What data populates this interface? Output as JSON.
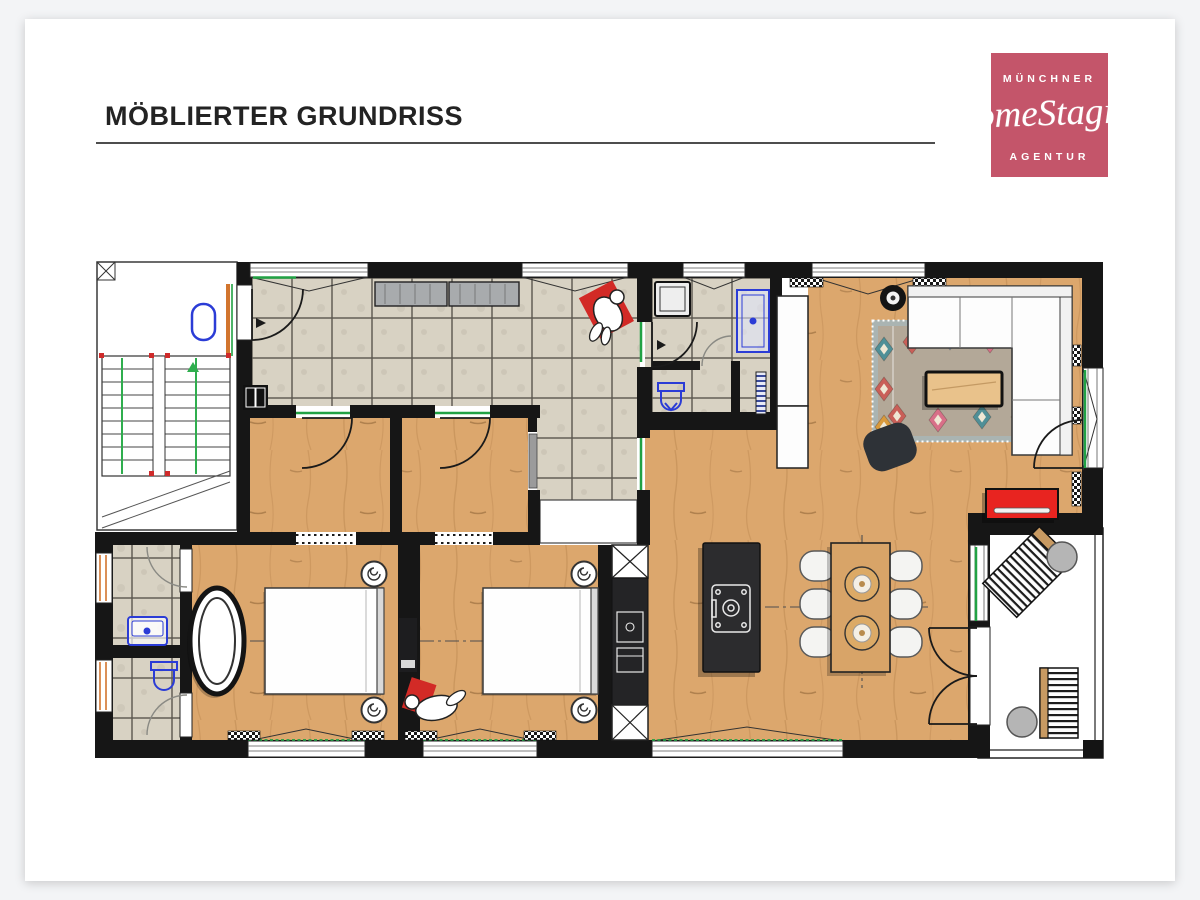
{
  "header": {
    "title": "MÖBLIERTER GRUNDRISS"
  },
  "logo": {
    "line1": "MÜNCHNER",
    "script": "HomeStaging",
    "line2": "AGENTUR"
  },
  "colors": {
    "accent": "#C4556A",
    "page-bg": "#f3f4f6",
    "slide-bg": "#ffffff",
    "title-color": "#232323",
    "rule-color": "#4d4d4d",
    "wall": "#161616",
    "wood": "#DCA76D",
    "tile": "#D8D2C3",
    "grout": "#5a564e",
    "fixture-blue": "#2b3cd6",
    "threshold-green": "#21a244",
    "door-orange": "#d2752e",
    "sideboard-red": "#e82420",
    "stair-green": "#2fae4e",
    "mark-red": "#cf2b2b"
  }
}
